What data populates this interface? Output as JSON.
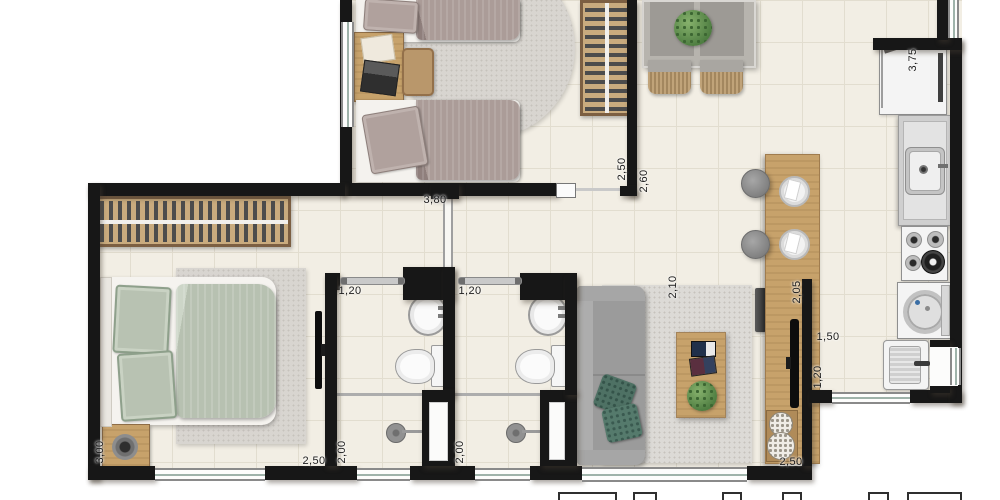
{
  "floorplan": {
    "type": "apartment-floor-plan-top-view",
    "dimension_labels": [
      {
        "text": "3,80",
        "orientation": "horizontal"
      },
      {
        "text": "2,50",
        "orientation": "vertical"
      },
      {
        "text": "2,60",
        "orientation": "vertical"
      },
      {
        "text": "3,75",
        "orientation": "vertical"
      },
      {
        "text": "1,20",
        "orientation": "horizontal"
      },
      {
        "text": "1,20",
        "orientation": "horizontal"
      },
      {
        "text": "2,10",
        "orientation": "vertical"
      },
      {
        "text": "2,05",
        "orientation": "vertical"
      },
      {
        "text": "1,50",
        "orientation": "horizontal"
      },
      {
        "text": "1,20",
        "orientation": "vertical"
      },
      {
        "text": "3,00",
        "orientation": "vertical"
      },
      {
        "text": "2,50",
        "orientation": "horizontal"
      },
      {
        "text": "2,00",
        "orientation": "vertical"
      },
      {
        "text": "2,00",
        "orientation": "vertical"
      },
      {
        "text": "2,50",
        "orientation": "horizontal"
      }
    ],
    "palette": {
      "wall": "#171717",
      "floor_tile": "#f2eee4",
      "tile_grout": "#e2ddcf",
      "wood": "#c7a26b",
      "sage_bedding": "#b7c1b1",
      "taupe_bedding": "#ab9c98",
      "sofa_gray": "#9a9a9a",
      "teal_pillow": "#4e7164",
      "plant_green": "#5d8f4e",
      "rug_gray": "#d8d5d0",
      "appliance_gray": "#e3e3e3"
    },
    "furniture": [
      "double-bed",
      "single-bed",
      "single-bed",
      "wardrobe",
      "wardrobe",
      "desk",
      "desk-chair",
      "nightstand",
      "table-lamp",
      "wall-tv",
      "counter-tv",
      "toilet",
      "toilet",
      "washbasin",
      "washbasin",
      "shower",
      "shower",
      "sofa",
      "throw-pillows",
      "round-rug",
      "bedroom-rug",
      "living-rug",
      "coffee-table",
      "plant",
      "plant",
      "plant",
      "dining-table",
      "dining-chairs",
      "bar-counter",
      "bar-stool",
      "bar-stool",
      "place-setting",
      "place-setting",
      "vases",
      "refrigerator",
      "kitchen-counter-sink",
      "cooktop",
      "washing-machine",
      "laundry-tub"
    ]
  }
}
